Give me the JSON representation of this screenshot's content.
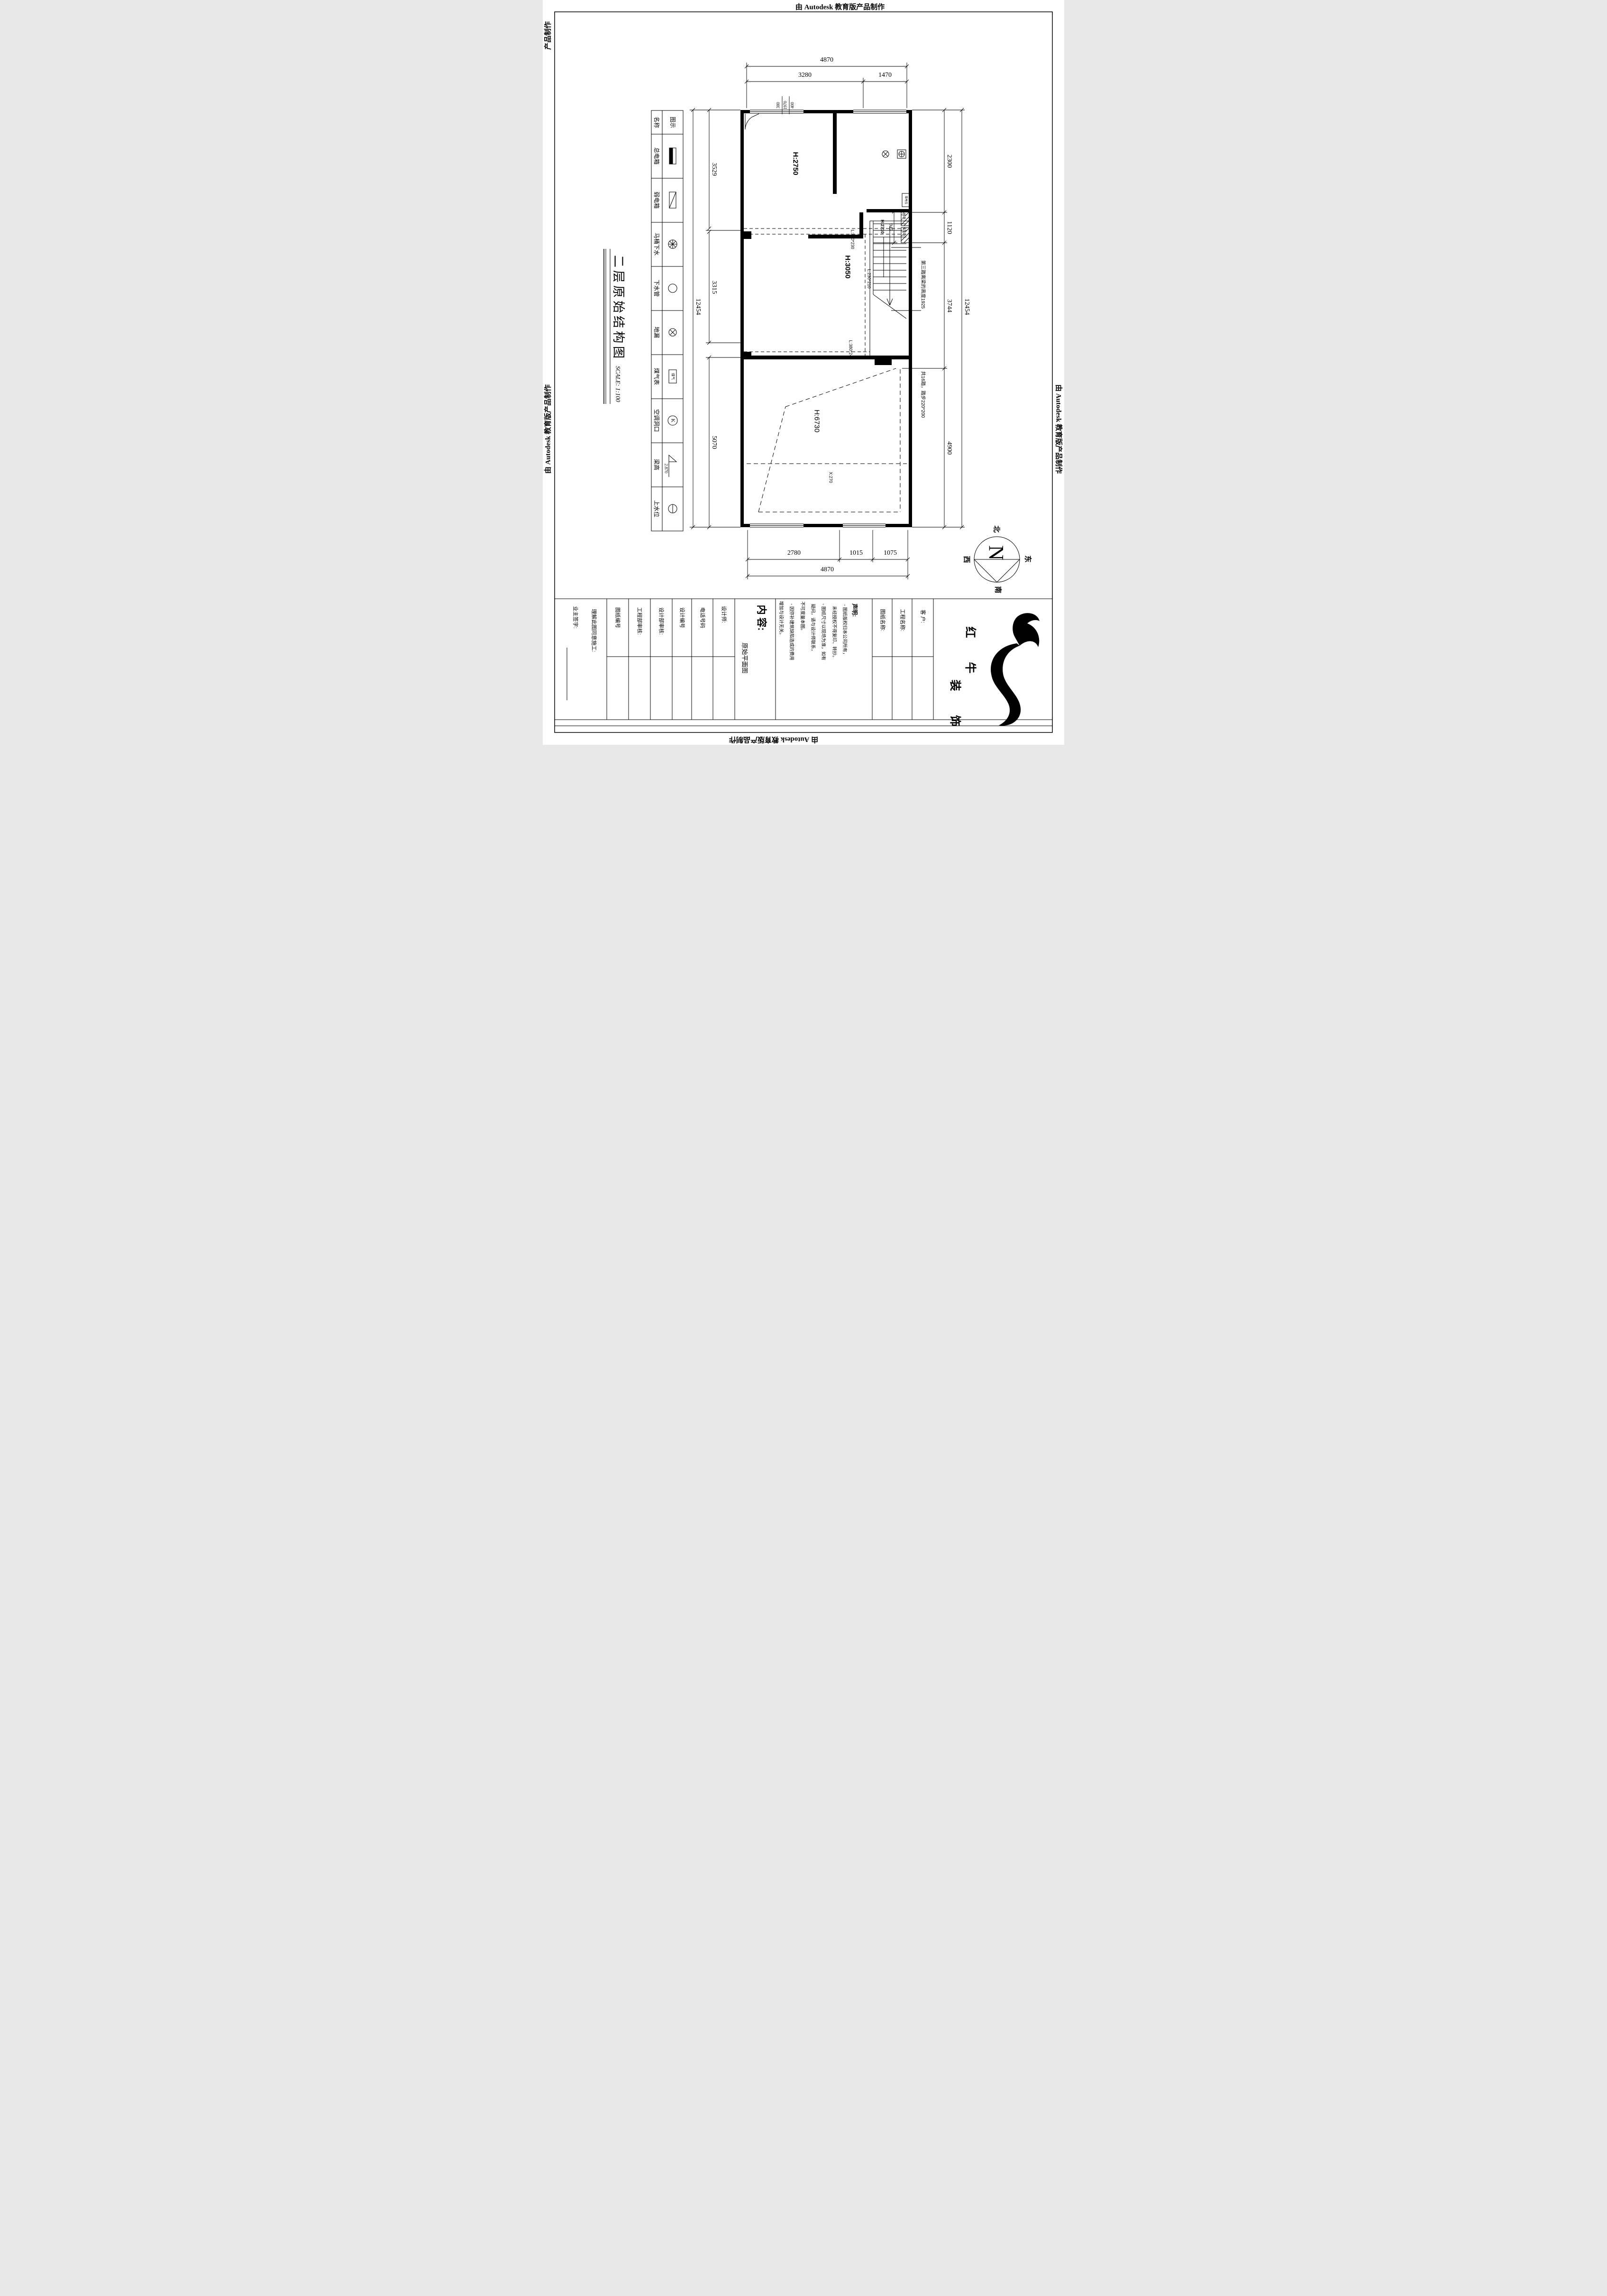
{
  "stamp": {
    "text": "由 Autodesk 教育版产品制作",
    "fragment": "产品制作"
  },
  "title": {
    "text": "二层原始结构图",
    "scale": "SCALE: 1:100"
  },
  "legend": {
    "header": {
      "name": "名称",
      "symbol": "图示"
    },
    "rows": [
      {
        "name": "总电箱"
      },
      {
        "name": "弱电箱"
      },
      {
        "name": "马桶下水"
      },
      {
        "name": "下水管"
      },
      {
        "name": "地漏"
      },
      {
        "name": "煤气表",
        "symbol_label": "煤气"
      },
      {
        "name": "空调洞口",
        "symbol_label": "K"
      },
      {
        "name": "梁高",
        "symbol_label": "2.870"
      },
      {
        "name": "上水位"
      }
    ]
  },
  "plan": {
    "room_top": "H:2750",
    "room_mid": "H:3050",
    "room_bottom": "H:6730",
    "headroom": "H:2710",
    "x_label": "X:270",
    "equipotential": "等电位",
    "weak_power": "弱电",
    "strong_power": "强电",
    "beam1": "L:200*230",
    "beam2": "L:230*210",
    "beam3": "L:380*240",
    "stair_note1": "第三踏离梁的高度1925",
    "stair_note2": "共16踏，踏步220*200"
  },
  "dims": {
    "top": {
      "overall": "4870",
      "seg1": "3280",
      "seg2": "1470",
      "stack1": "380",
      "stack2": "1970",
      "stack3": "400"
    },
    "bottom": {
      "seg1": "2780",
      "seg2": "1015",
      "seg3": "1075",
      "overall": "4870"
    },
    "left": {
      "seg1": "3529",
      "seg2": "3315",
      "seg3": "5070",
      "overall": "12454"
    },
    "right": {
      "seg1": "2300",
      "seg2": "1120",
      "seg3": "3744",
      "seg4": "4900",
      "overall": "12454",
      "stair_width": "945"
    }
  },
  "compass": {
    "letter": "N",
    "north": "北",
    "south": "南",
    "east": "东",
    "west": "西"
  },
  "titleblock": {
    "owner_sign": "业主签字:",
    "agree": "理解此图同意施工:",
    "drawing_no": "图纸编号",
    "eng_audit": "工程部审核:",
    "design_audit": "设计部审核:",
    "design_no": "设计编号",
    "phone": "电话号码",
    "designer": "设计师:",
    "content_label": "内 容:",
    "content_value": "原始平面图",
    "declaration_title": "声明:",
    "decl1": "◦ 图纸版权归本公司所有，",
    "decl2": "未经授权不得复印、转抄。",
    "decl3": "◦ 图纸尺寸以现场为准，如有",
    "decl4": "疑问，请与设计师联系，",
    "decl5": "不可度量本图。",
    "decl6": "◦ 因弥补建筑缺陷造成的费用",
    "decl7": "增加与设计无关。",
    "drawing_name": "图纸名称:",
    "project_name": "工程名称:",
    "client": "客 户:",
    "brand_line1": "红 牛",
    "brand_line2": "装 饰"
  }
}
